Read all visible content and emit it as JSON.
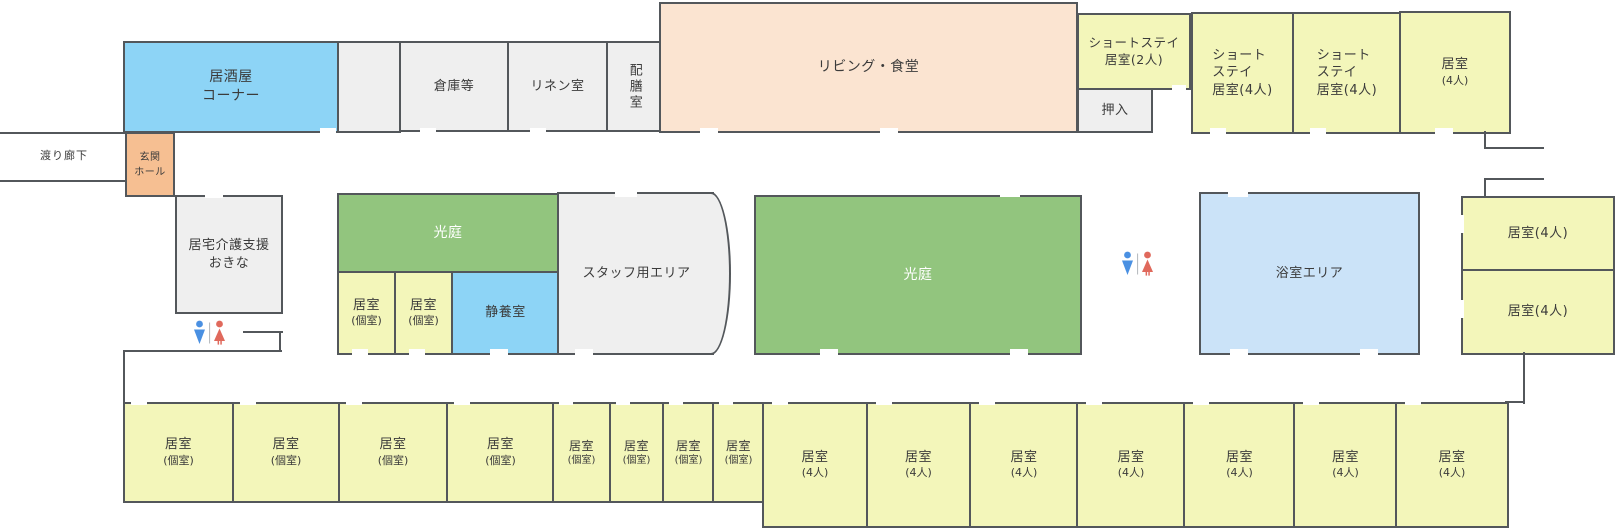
{
  "colors": {
    "wall": "#53575b",
    "gray": "#efefef",
    "blue": "#8dd4f6",
    "yellow": "#f3f6ba",
    "green": "#92c57e",
    "peach": "#fbe4d1",
    "orange": "#f6bf92",
    "bath": "#cbe3f8",
    "toilet-male": "#4a90e2",
    "toilet-female": "#e0695c",
    "text": "#3b3b3b"
  },
  "icons": {
    "restroom_male": "toilet-male-pictogram",
    "restroom_female": "toilet-female-pictogram"
  },
  "rooms": {
    "izakaya": {
      "lines": [
        "居酒屋",
        "コーナー"
      ]
    },
    "souko": {
      "label": "倉庫等"
    },
    "linen": {
      "label": "リネン室"
    },
    "haizen": {
      "label": "配膳室"
    },
    "living": {
      "label": "リビング・食堂"
    },
    "shortstay2": {
      "lines": [
        "ショートステイ",
        "居室(2人)"
      ]
    },
    "oshiire": {
      "label": "押入"
    },
    "shortstay4": {
      "lines": [
        "ショート",
        "ステイ",
        "居室(4人)"
      ]
    },
    "room4_two_line": {
      "lines": [
        "居室",
        "(4人)"
      ]
    },
    "watari": {
      "label": "渡り廊下"
    },
    "genkan": {
      "lines": [
        "玄関",
        "ホール"
      ]
    },
    "kyotaku": {
      "lines": [
        "居宅介護支援",
        "おきな"
      ]
    },
    "kouniwa": {
      "label": "光庭"
    },
    "koshitsu": {
      "lines": [
        "居室",
        "(個室)"
      ]
    },
    "seiyou": {
      "label": "静養室"
    },
    "staff": {
      "label": "スタッフ用エリア"
    },
    "bath": {
      "label": "浴室エリア"
    },
    "room4_one_line": {
      "label": "居室(4人)"
    }
  }
}
